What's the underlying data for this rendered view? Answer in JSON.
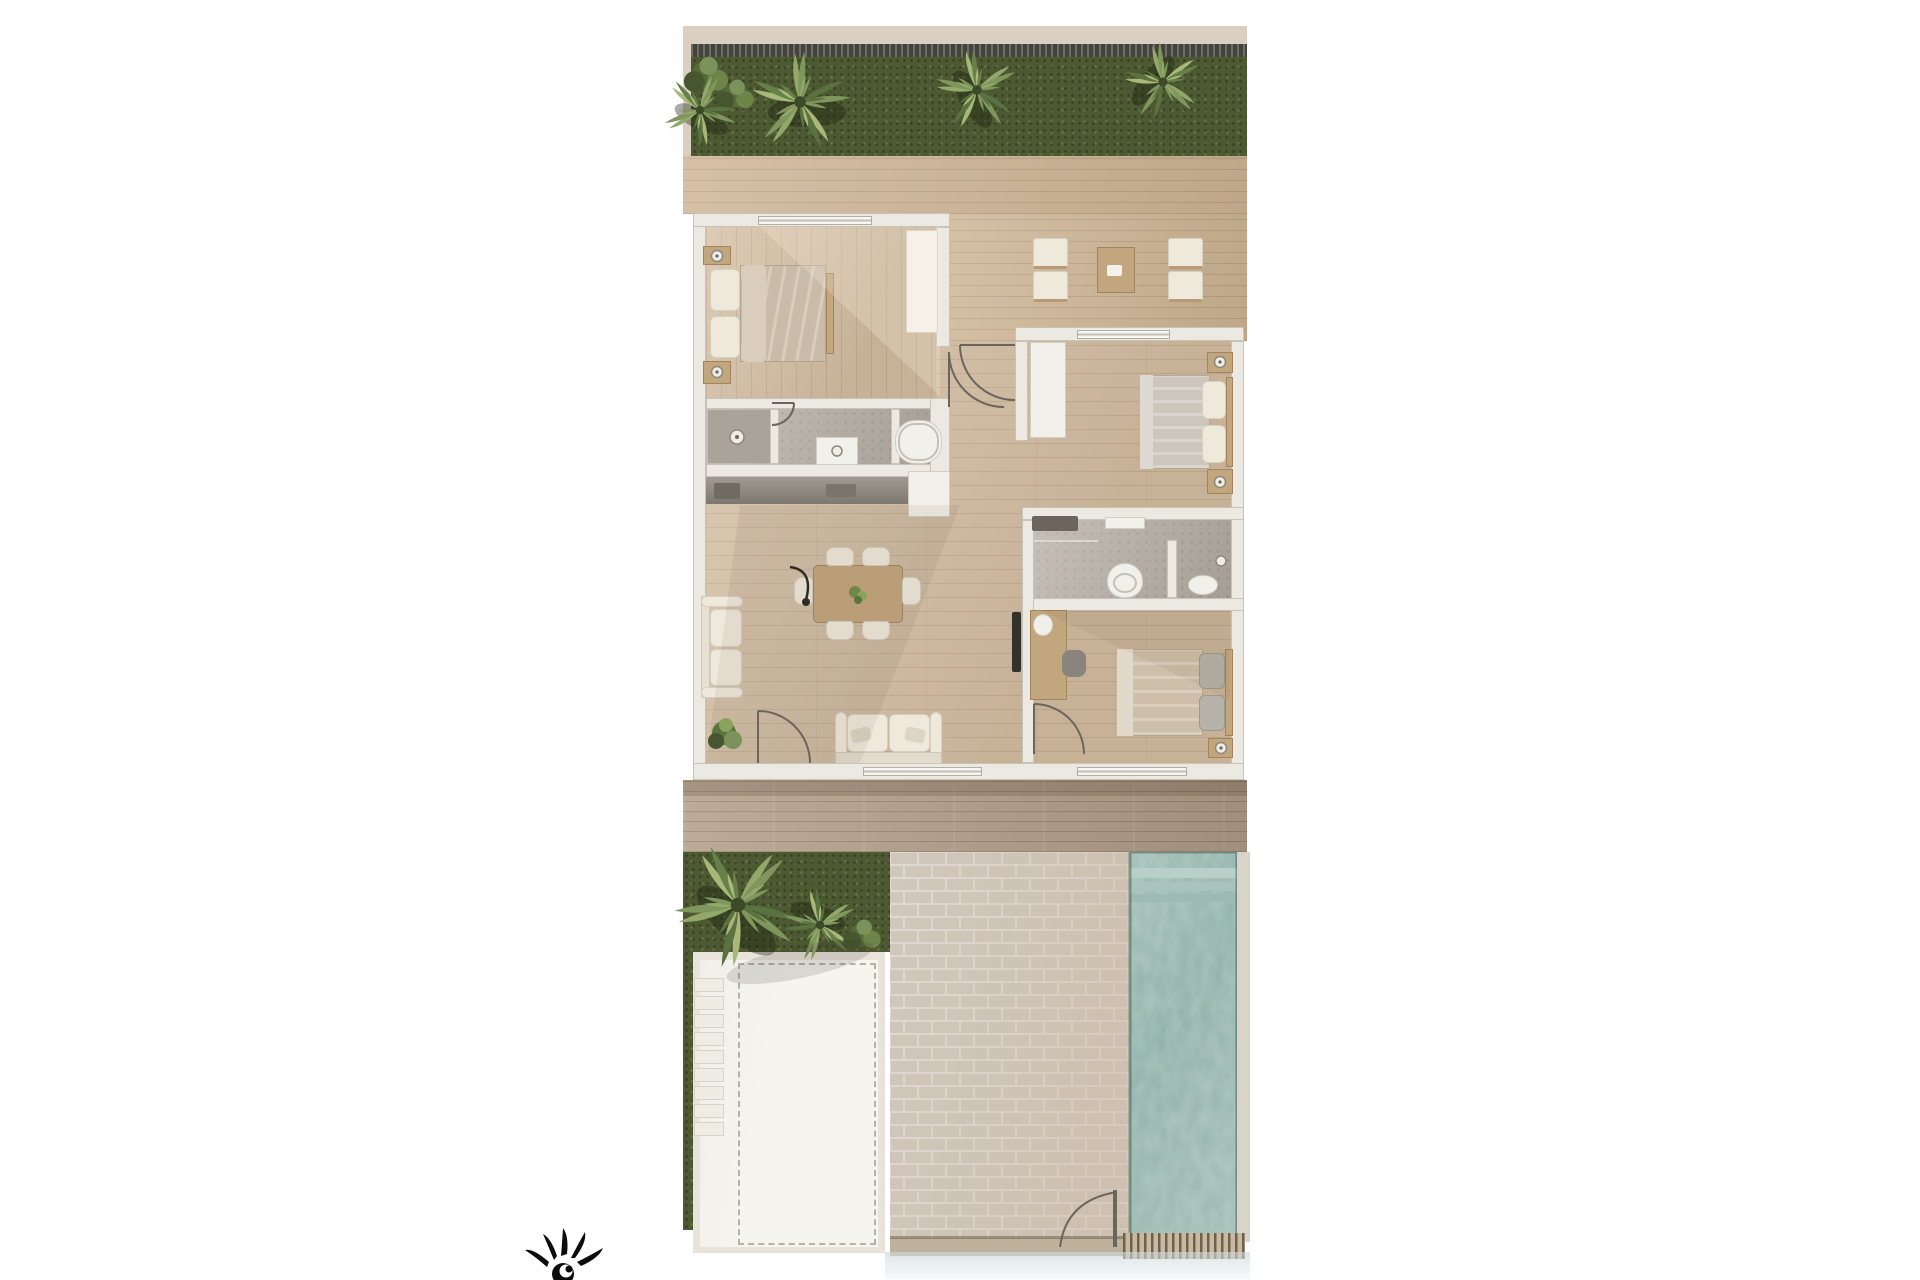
{
  "scene": {
    "kind": "residential-floor-plan-3d-render",
    "orientation": "top-down",
    "areas": [
      "top-garden",
      "top-terrace-deck",
      "master-bedroom",
      "master-bathroom",
      "kitchen-counter",
      "living-dining-room",
      "entry-hall",
      "bedroom-2",
      "bathroom-2",
      "bedroom-3",
      "rear-deck",
      "lower-garden",
      "white-terrace-pad",
      "stepping-stones",
      "brick-path",
      "swimming-pool"
    ],
    "furniture": [
      "double-bed-master",
      "nightstands-with-lamps",
      "wardrobe",
      "lounge-chairs",
      "coffee-table",
      "double-bed-2",
      "double-bed-3",
      "desk-with-chair",
      "tv-panel",
      "sofa-chaise",
      "loveseat",
      "dining-table-6-chairs",
      "floor-lamp",
      "potted-plant",
      "bathtub",
      "shower",
      "toilet",
      "vanity-sink",
      "fridge-cabinet"
    ],
    "vegetation": [
      "palm-trees-top-garden",
      "large-palm-lower-garden",
      "hedge"
    ],
    "logo": "sun-sketch-mark-bottom-left"
  },
  "palette": {
    "wall": "#ece9e2",
    "wall_edge": "#c8c3b7",
    "wood": "#d3bda1",
    "wood_line": "rgba(125,90,55,0.16)",
    "wood_furn": "#c2a67e",
    "deck": "#cdb392",
    "deck_low": "#b2a089",
    "grass": "#4d5a31",
    "tile": "#b2aba1",
    "counter": "#8f8880",
    "white_furn": "#f2f0ea",
    "duvet": "#cabba8",
    "pillow": "#efe9dc",
    "brick": "#d0c8bc",
    "mortar": "#e0dad1",
    "brick_warm": "#c9b6a2",
    "pool": "#92b4ac",
    "pool_light": "#b8d0c8",
    "pad": "#f6f4ef",
    "pad_frame": "#e8e4da",
    "fence": "#45443c",
    "topwall": "#dacfc0",
    "ink": "#111111"
  }
}
